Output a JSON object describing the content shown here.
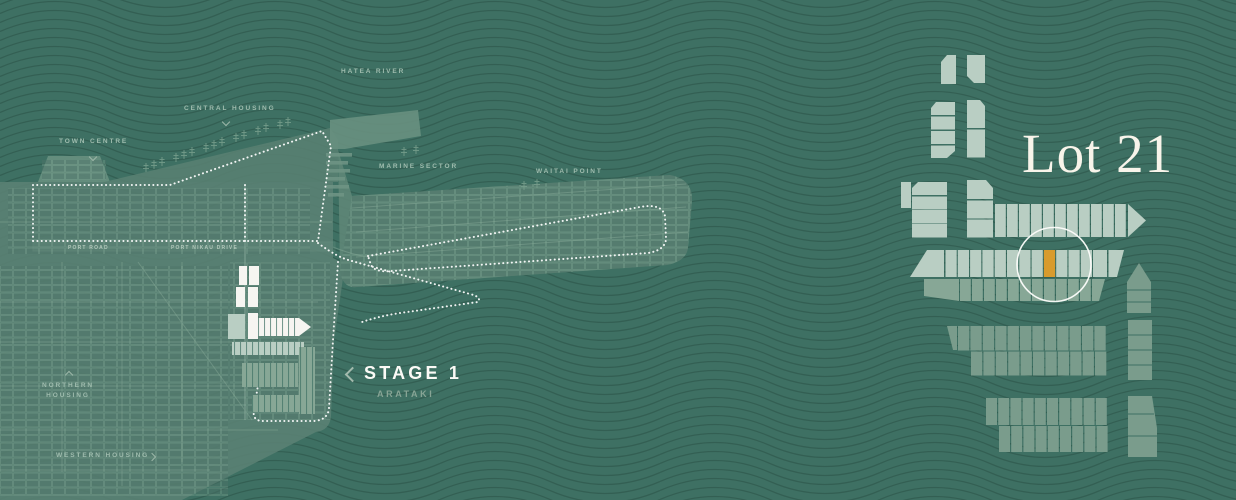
{
  "colors": {
    "background": "#3E7063",
    "wave": "#2F594D",
    "land": "#5A8173",
    "land_bright": "#68907F",
    "lot_pale": "#B9CEC3",
    "lot_mid": "#87A796",
    "lot_dark": "#7A9C8C",
    "lot_white": "#F6F5F1",
    "highlight": "#D89B2D",
    "dotted": "#FFFFFF",
    "circle": "#FDFDFB"
  },
  "map": {
    "labels": {
      "hatea_river": "HATEA RIVER",
      "central_housing": "CENTRAL HOUSING",
      "town_centre": "TOWN CENTRE",
      "marine_sector": "MARINE SECTOR",
      "waitai_point": "WAITAI POINT",
      "northern_housing": "NORTHERN\nHOUSING",
      "western_housing": "WESTERN HOUSING",
      "port_road": "PORT ROAD",
      "port_nikau_drive": "PORT NIKAU DRIVE"
    },
    "stage": {
      "name": "STAGE 1",
      "subtitle": "ARATAKI"
    }
  },
  "detail": {
    "selected_lot": "Lot 21"
  }
}
